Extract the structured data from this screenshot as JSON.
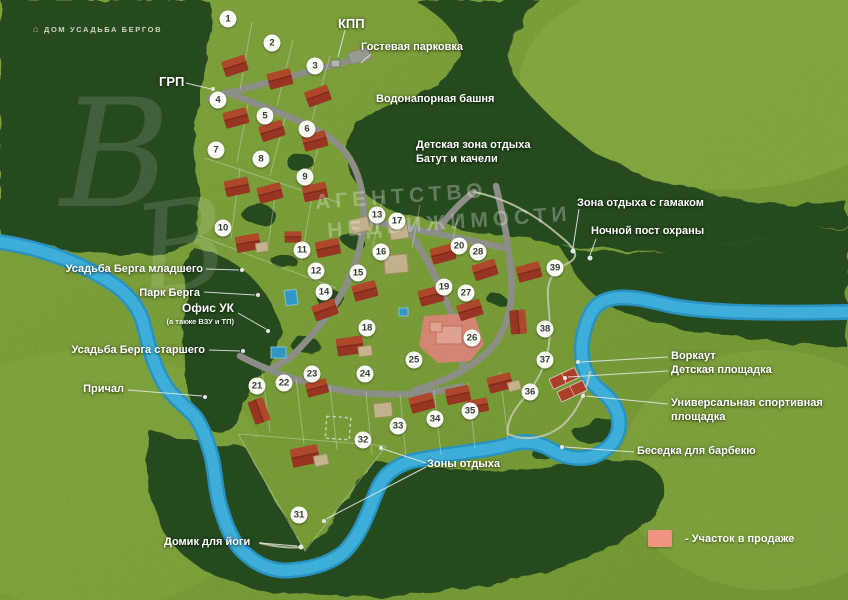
{
  "branding": {
    "logo_text": "ДОМ УСАДЬБА БЕРГОВ"
  },
  "watermark": {
    "monogram": "В",
    "line1": "АГЕНТСТВО",
    "line2": "НЕДВИЖИМОСТИ"
  },
  "legend": {
    "swatch_color": "#ef9382",
    "label": "- Участок в продаже"
  },
  "colors": {
    "field": "#86ad3f",
    "forest": "#2b5323",
    "river": "#38b5e8",
    "road": "#9c9e96",
    "roof": "#ab3d28",
    "beige": "#d9c49c",
    "sale_plot": "#ef9382"
  },
  "plots": [
    {
      "n": "1",
      "x": 228,
      "y": 19
    },
    {
      "n": "2",
      "x": 272,
      "y": 43
    },
    {
      "n": "3",
      "x": 315,
      "y": 66
    },
    {
      "n": "4",
      "x": 218,
      "y": 100
    },
    {
      "n": "5",
      "x": 265,
      "y": 116
    },
    {
      "n": "6",
      "x": 307,
      "y": 129
    },
    {
      "n": "7",
      "x": 216,
      "y": 150
    },
    {
      "n": "8",
      "x": 261,
      "y": 159
    },
    {
      "n": "9",
      "x": 305,
      "y": 177
    },
    {
      "n": "10",
      "x": 223,
      "y": 228
    },
    {
      "n": "11",
      "x": 302,
      "y": 250
    },
    {
      "n": "12",
      "x": 316,
      "y": 271
    },
    {
      "n": "13",
      "x": 377,
      "y": 215
    },
    {
      "n": "14",
      "x": 324,
      "y": 292
    },
    {
      "n": "15",
      "x": 358,
      "y": 273
    },
    {
      "n": "16",
      "x": 381,
      "y": 252
    },
    {
      "n": "17",
      "x": 397,
      "y": 221
    },
    {
      "n": "18",
      "x": 367,
      "y": 328
    },
    {
      "n": "19",
      "x": 444,
      "y": 287
    },
    {
      "n": "20",
      "x": 459,
      "y": 246
    },
    {
      "n": "21",
      "x": 257,
      "y": 386
    },
    {
      "n": "22",
      "x": 284,
      "y": 383
    },
    {
      "n": "23",
      "x": 312,
      "y": 374
    },
    {
      "n": "24",
      "x": 365,
      "y": 374
    },
    {
      "n": "25",
      "x": 414,
      "y": 360
    },
    {
      "n": "26",
      "x": 472,
      "y": 338
    },
    {
      "n": "27",
      "x": 466,
      "y": 293
    },
    {
      "n": "28",
      "x": 478,
      "y": 252
    },
    {
      "n": "31",
      "x": 299,
      "y": 515
    },
    {
      "n": "32",
      "x": 363,
      "y": 440
    },
    {
      "n": "33",
      "x": 398,
      "y": 426
    },
    {
      "n": "34",
      "x": 435,
      "y": 419
    },
    {
      "n": "35",
      "x": 470,
      "y": 411
    },
    {
      "n": "36",
      "x": 530,
      "y": 392
    },
    {
      "n": "37",
      "x": 545,
      "y": 360
    },
    {
      "n": "38",
      "x": 545,
      "y": 329
    },
    {
      "n": "39",
      "x": 555,
      "y": 268
    }
  ],
  "labels": [
    {
      "id": "kpp",
      "lines": [
        "КПП"
      ],
      "x": 338,
      "y": 16,
      "size": 13
    },
    {
      "id": "guest-parking",
      "lines": [
        "Гостевая парковка"
      ],
      "x": 361,
      "y": 40
    },
    {
      "id": "grp",
      "lines": [
        "ГРП"
      ],
      "x": 159,
      "y": 74,
      "size": 13
    },
    {
      "id": "water-tower",
      "lines": [
        "Водонапорная башня"
      ],
      "x": 376,
      "y": 92
    },
    {
      "id": "kids-zone",
      "lines": [
        "Детская зона отдыха",
        "Батут и качели"
      ],
      "x": 416,
      "y": 138
    },
    {
      "id": "hammock-zone",
      "lines": [
        "Зона отдыха с гамаком"
      ],
      "x": 577,
      "y": 196
    },
    {
      "id": "night-post",
      "lines": [
        "Ночной пост охраны"
      ],
      "x": 591,
      "y": 224
    },
    {
      "id": "berg-jr",
      "lines": [
        "Усадьба Берга младшего"
      ],
      "x": 203,
      "y": 262,
      "align": "right"
    },
    {
      "id": "berg-park",
      "lines": [
        "Парк Берга"
      ],
      "x": 200,
      "y": 286,
      "align": "right"
    },
    {
      "id": "office",
      "lines": [
        "Офис УК"
      ],
      "sub": "(а также ВЗУ и ТП)",
      "x": 234,
      "y": 301,
      "align": "right",
      "size": 12
    },
    {
      "id": "berg-sr",
      "lines": [
        "Усадьба Берга старшего"
      ],
      "x": 205,
      "y": 343,
      "align": "right"
    },
    {
      "id": "pier",
      "lines": [
        "Причал"
      ],
      "x": 124,
      "y": 382,
      "align": "right"
    },
    {
      "id": "workout",
      "lines": [
        "Воркаут",
        "Детская площадка"
      ],
      "x": 671,
      "y": 349
    },
    {
      "id": "sports-ground",
      "lines": [
        "Универсальная спортивная",
        "площадка"
      ],
      "x": 671,
      "y": 396
    },
    {
      "id": "bbq",
      "lines": [
        "Беседка для барбекю"
      ],
      "x": 637,
      "y": 444
    },
    {
      "id": "rest-zones",
      "lines": [
        "Зоны отдыха"
      ],
      "x": 427,
      "y": 457
    },
    {
      "id": "yoga-house",
      "lines": [
        "Домик для йоги"
      ],
      "x": 164,
      "y": 535
    }
  ]
}
